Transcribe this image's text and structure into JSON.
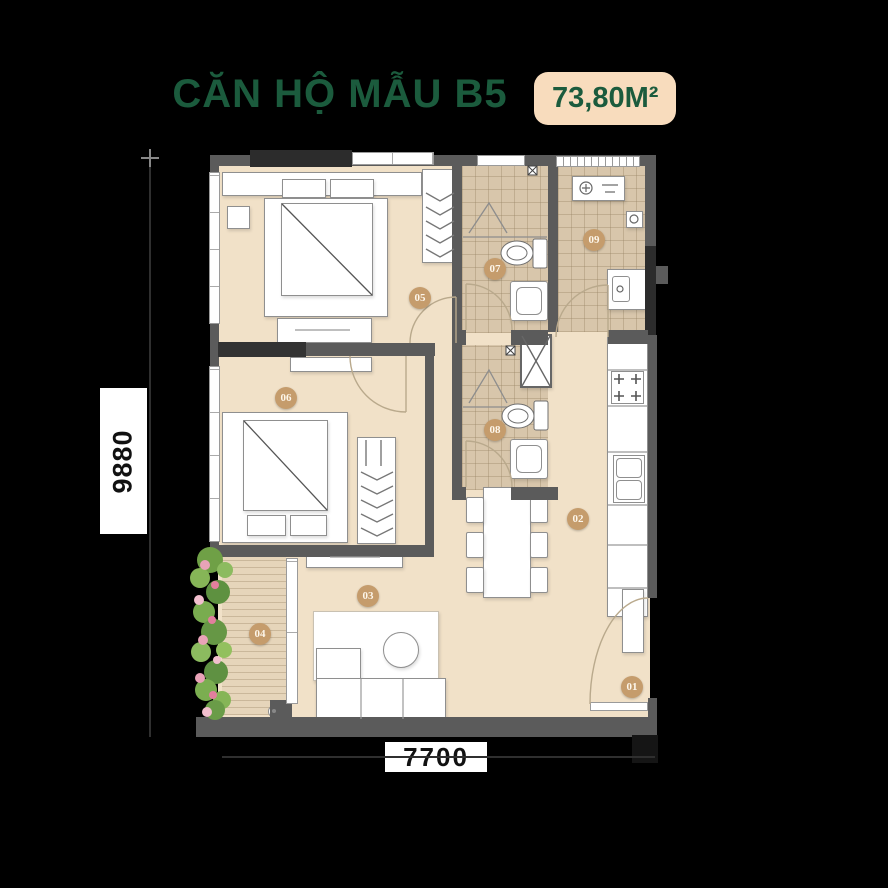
{
  "title": "CĂN HỘ MẪU B5",
  "area_badge": "73,80M²",
  "dimensions": {
    "height": "9880",
    "width": "7700"
  },
  "rooms": [
    {
      "n": "01"
    },
    {
      "n": "02"
    },
    {
      "n": "03"
    },
    {
      "n": "04"
    },
    {
      "n": "05"
    },
    {
      "n": "06"
    },
    {
      "n": "07"
    },
    {
      "n": "08"
    },
    {
      "n": "09"
    }
  ],
  "colors": {
    "title_green": "#1B5B3D",
    "badge_bg": "#F8DCBD",
    "badge_text": "#1B5B3D",
    "room_badge": "#C59C6C",
    "floor": "#F1E1C8",
    "tile": "#D8C6AB",
    "deck": "#E6D5BA",
    "wall": "#5B5B5B",
    "background": "#000000"
  }
}
